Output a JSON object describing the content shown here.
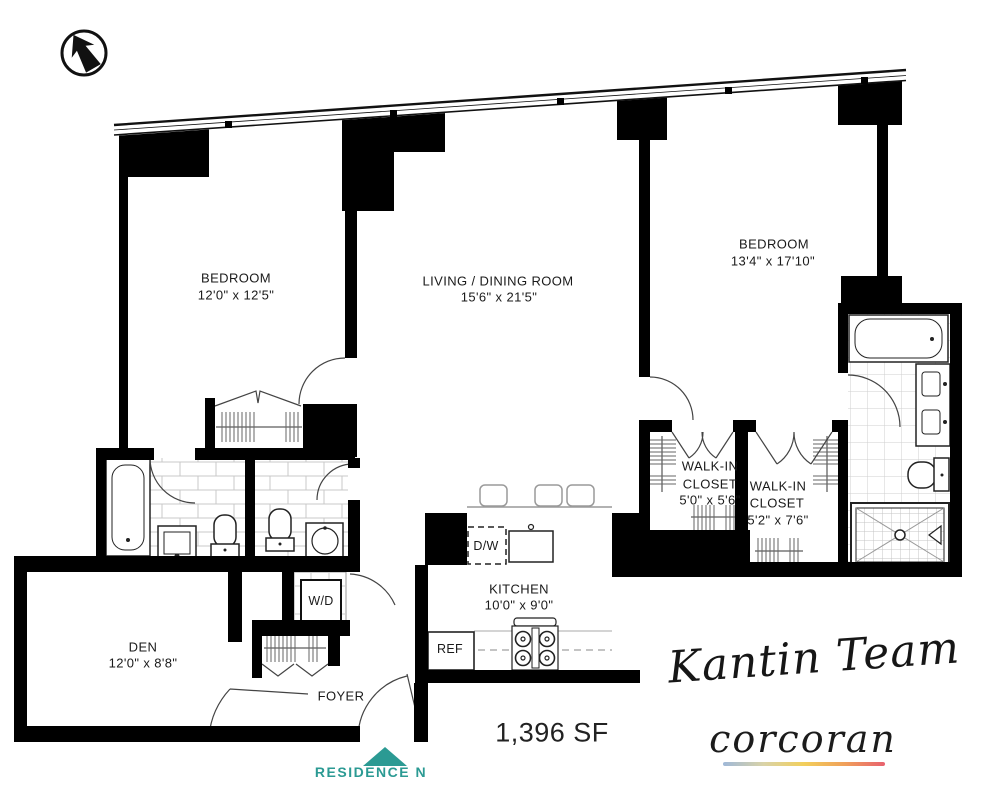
{
  "rooms": {
    "bedroom_left": {
      "name": "BEDROOM",
      "dims": "12'0\" x 12'5\""
    },
    "living_dining": {
      "name": "LIVING / DINING ROOM",
      "dims": "15'6\" x 21'5\""
    },
    "bedroom_right": {
      "name": "BEDROOM",
      "dims": "13'4\" x 17'10\""
    },
    "walk_in_closet_1": {
      "line1": "WALK-IN",
      "line2": "CLOSET",
      "dims": "5'0\" x 5'6\""
    },
    "walk_in_closet_2": {
      "line1": "WALK-IN",
      "line2": "CLOSET",
      "dims": "5'2\" x 7'6\""
    },
    "kitchen": {
      "name": "KITCHEN",
      "dims": "10'0\" x 9'0\""
    },
    "den": {
      "name": "DEN",
      "dims": "12'0\" x 8'8\""
    },
    "foyer": {
      "name": "FOYER"
    }
  },
  "appliances": {
    "washer_dryer": "W/D",
    "dishwasher": "D/W",
    "refrigerator": "REF"
  },
  "summary": {
    "area": "1,396 SF",
    "residence": "RESIDENCE N"
  },
  "branding": {
    "team_signature": "Kantin Team",
    "brokerage": "corcoran"
  },
  "colors": {
    "wall": "#000000",
    "teal": "#2b9a93",
    "underline_gradient": [
      "#9fb8d8",
      "#f2cf5b",
      "#e8616e"
    ]
  }
}
